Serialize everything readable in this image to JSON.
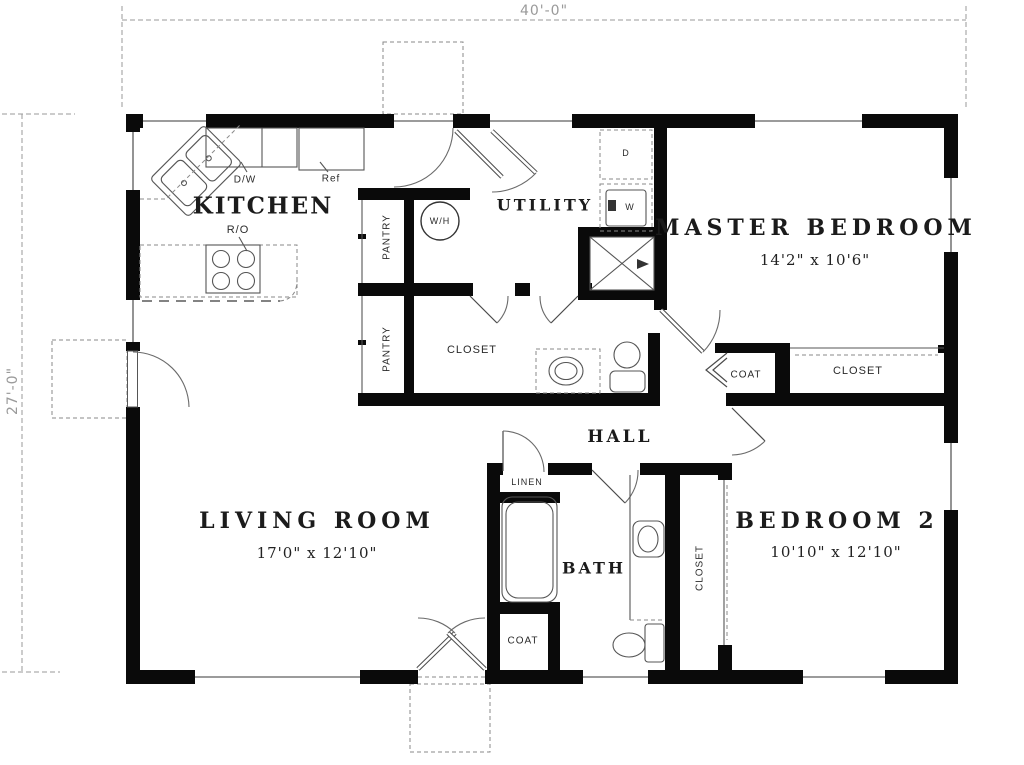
{
  "title": "Floor plan",
  "dimensions": {
    "width_label": "40'-0\"",
    "height_label": "27'-0\""
  },
  "rooms": {
    "kitchen": {
      "name": "KITCHEN"
    },
    "utility": {
      "name": "UTILITY"
    },
    "master_bedroom": {
      "name": "MASTER BEDROOM",
      "size": "14'2\" x 10'6\""
    },
    "living_room": {
      "name": "LIVING ROOM",
      "size": "17'0\" x 12'10\""
    },
    "bedroom_2": {
      "name": "BEDROOM 2",
      "size": "10'10\" x 12'10\""
    },
    "hall": {
      "name": "HALL"
    },
    "bath": {
      "name": "BATH"
    }
  },
  "closets": {
    "pantry_upper": "PANTRY",
    "pantry_lower": "PANTRY",
    "hall_closet": "CLOSET",
    "master_coat": "COAT",
    "master_closet": "CLOSET",
    "linen": "LINEN",
    "entry_coat": "COAT",
    "bedroom2_closet": "CLOSET"
  },
  "appliances": {
    "dishwasher": "D/W",
    "refrigerator": "Ref",
    "range_oven": "R/O",
    "water_heater": "W/H",
    "dryer": "D",
    "washer": "W"
  },
  "colors": {
    "wall": "#0a0a0a",
    "line": "#6f6f6f",
    "dim": "#9a9a9a",
    "bg": "#ffffff"
  }
}
